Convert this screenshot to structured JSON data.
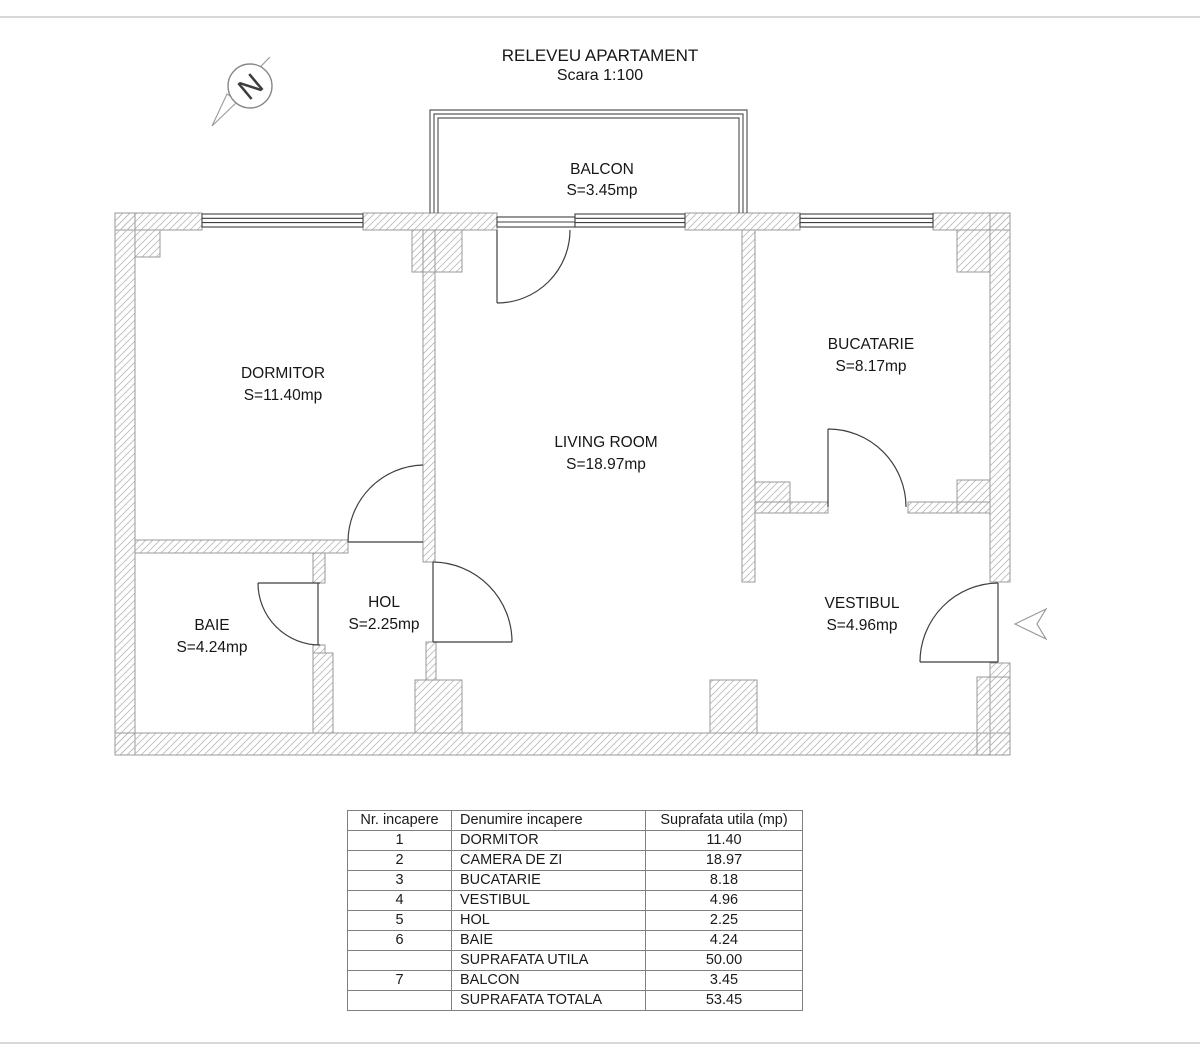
{
  "page": {
    "title": "RELEVEU APARTAMENT",
    "subtitle": "Scara 1:100",
    "north_label": "N"
  },
  "rooms": {
    "balcon": {
      "name": "BALCON",
      "area": "S=3.45mp"
    },
    "dormitor": {
      "name": "DORMITOR",
      "area": "S=11.40mp"
    },
    "living": {
      "name": "LIVING ROOM",
      "area": "S=18.97mp"
    },
    "bucatarie": {
      "name": "BUCATARIE",
      "area": "S=8.17mp"
    },
    "vestibul": {
      "name": "VESTIBUL",
      "area": "S=4.96mp"
    },
    "hol": {
      "name": "HOL",
      "area": "S=2.25mp"
    },
    "baie": {
      "name": "BAIE",
      "area": "S=4.24mp"
    }
  },
  "table": {
    "headers": [
      "Nr. incapere",
      "Denumire incapere",
      "Suprafata utila (mp)"
    ],
    "rows": [
      {
        "nr": "1",
        "name": "DORMITOR",
        "area": "11.40"
      },
      {
        "nr": "2",
        "name": "CAMERA DE ZI",
        "area": "18.97"
      },
      {
        "nr": "3",
        "name": "BUCATARIE",
        "area": "8.18"
      },
      {
        "nr": "4",
        "name": "VESTIBUL",
        "area": "4.96"
      },
      {
        "nr": "5",
        "name": "HOL",
        "area": "2.25"
      },
      {
        "nr": "6",
        "name": "BAIE",
        "area": "4.24"
      },
      {
        "nr": "",
        "name": "SUPRAFATA UTILA",
        "area": "50.00"
      },
      {
        "nr": "7",
        "name": "BALCON",
        "area": "3.45"
      },
      {
        "nr": "",
        "name": "SUPRAFATA TOTALA",
        "area": "53.45"
      }
    ]
  },
  "colors": {
    "wall_hatch": "#bdbdbd",
    "wall_outline": "#9a9a9a",
    "joinery_line": "#3f3f3f",
    "table_border": "#7f7f7f",
    "page_rule": "#d8d8d8",
    "text": "#161616"
  }
}
